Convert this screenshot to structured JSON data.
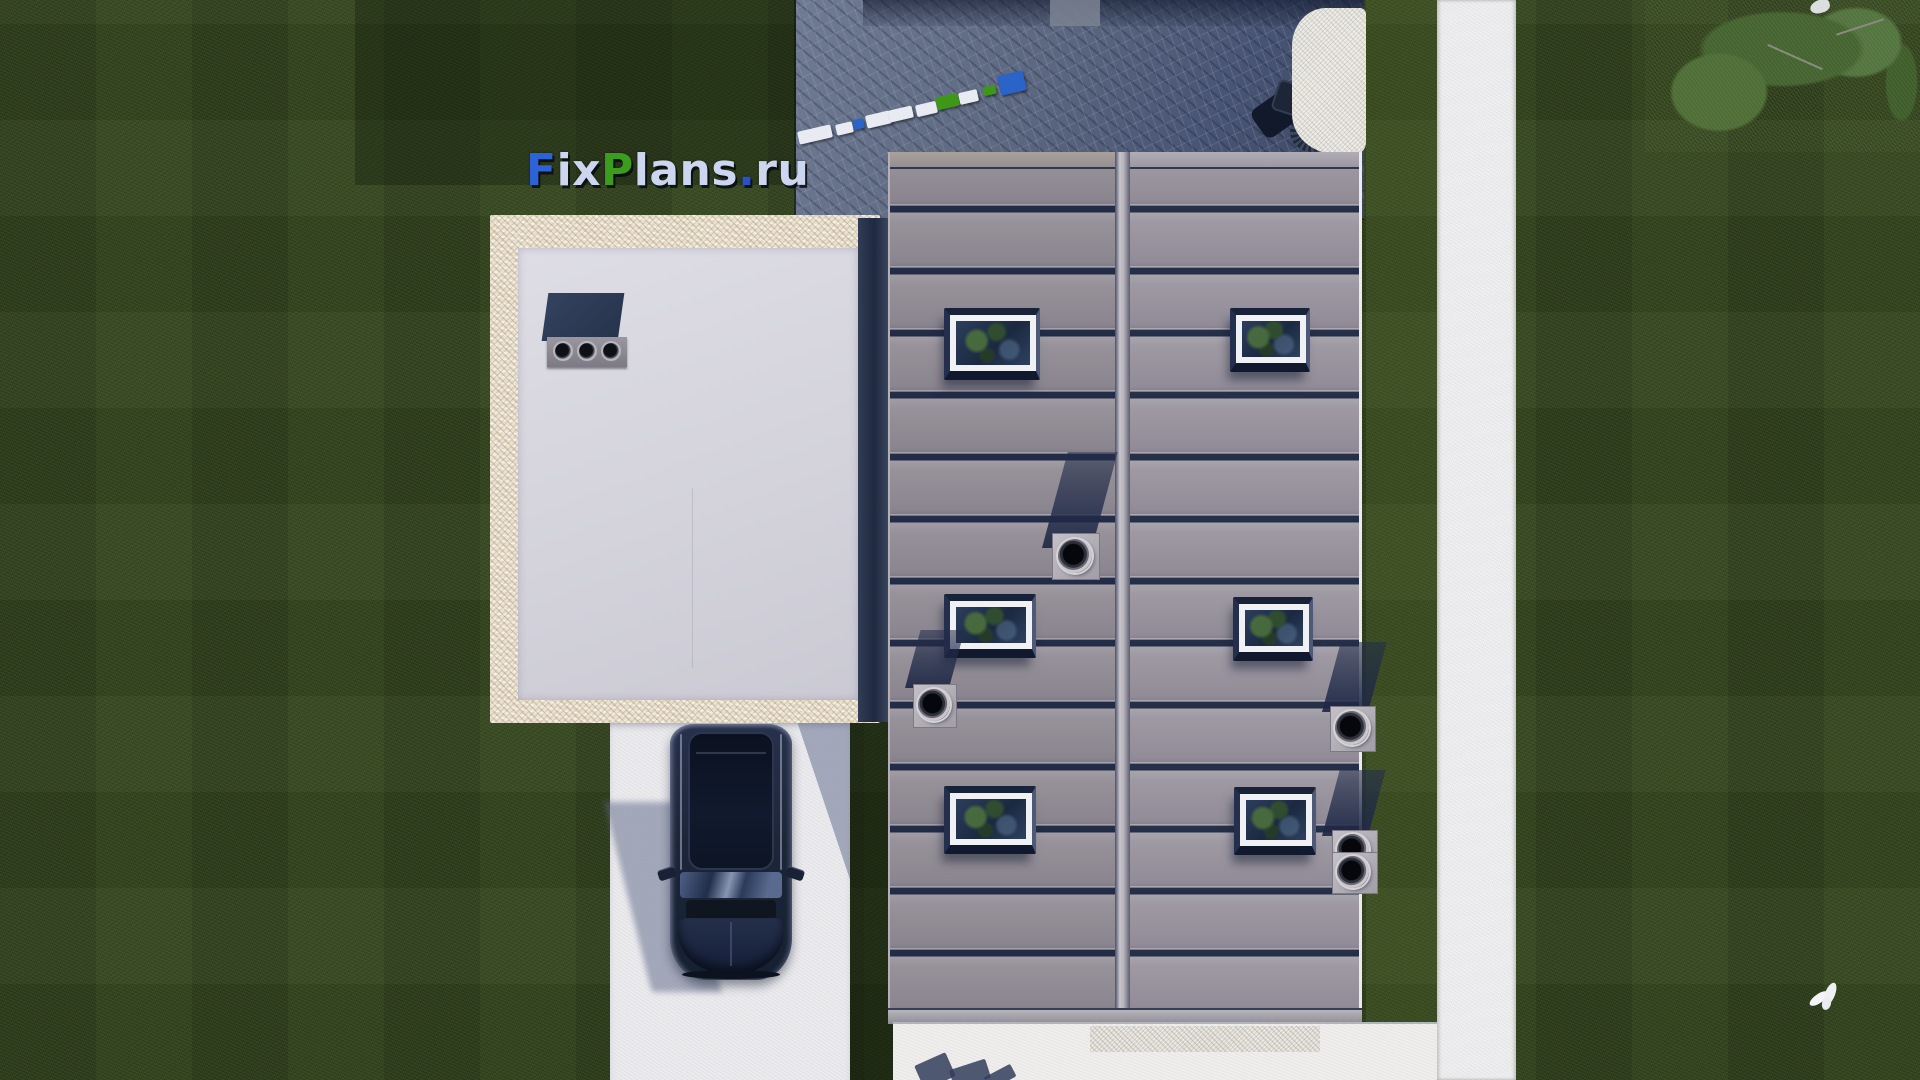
{
  "watermark": {
    "text": "FixPlans.ru",
    "parts": [
      {
        "text": "F"
      },
      {
        "text": "ix"
      },
      {
        "text": "P"
      },
      {
        "text": "lans"
      },
      {
        "text": "."
      },
      {
        "text": "ru"
      }
    ]
  },
  "palette": {
    "logo_blue": "#2e63d8",
    "logo_green": "#3b9c1d",
    "logo_light": "#ccd6ee",
    "lawn_green": "#31421f",
    "metal_roof_gray": "#948f98",
    "roof_seam_navy": "#232c46",
    "flat_roof_gray": "#d6d5dd",
    "travertine_beige": "#e9e2d2",
    "patio_stone_blue": "#56627c",
    "concrete_white": "#f1f1f3",
    "car_navy": "#1c2539",
    "paver_blue": "#2a64c8",
    "paver_green": "#3f9718"
  }
}
